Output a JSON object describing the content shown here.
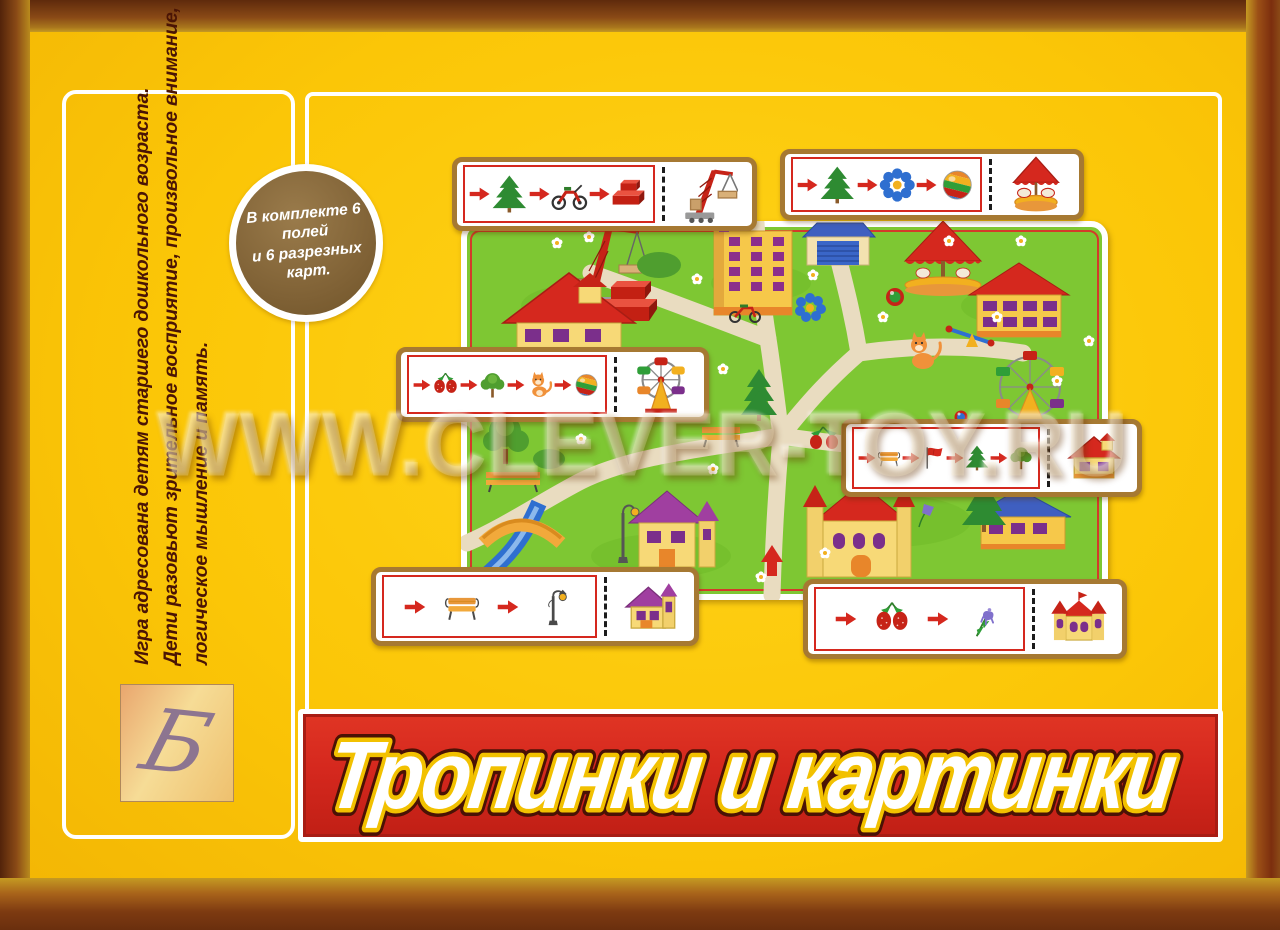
{
  "title": {
    "text": "Тропинки и картинки"
  },
  "badge": {
    "line1": "В комплекте 6 полей",
    "line2": "и 6 разрезных карт."
  },
  "left_panel": {
    "line1": "Игра адресована детям старшего дошкольного возраста.",
    "line2": "Дети разовьют зрительное восприятие, произвольное внимание,",
    "line3": "логическое мышление и память."
  },
  "watermark": {
    "text": "WWW.CLEVER-TOY.RU"
  },
  "logo": {
    "glyph": "Б"
  },
  "cards": [
    {
      "position": "top-left",
      "sequence": [
        "fir-tree",
        "motorcycle",
        "red-blocks"
      ],
      "target": "crane"
    },
    {
      "position": "top-right",
      "sequence": [
        "fir-tree",
        "blue-flower",
        "striped-ball"
      ],
      "target": "carousel"
    },
    {
      "position": "middle-left",
      "sequence": [
        "strawberry",
        "green-tree",
        "kitten",
        "striped-ball"
      ],
      "target": "ferris-wheel"
    },
    {
      "position": "middle-right",
      "sequence": [
        "bench",
        "red-flag",
        "fir-tree",
        "green-tree"
      ],
      "target": "red-roof-house"
    },
    {
      "position": "bottom-left",
      "sequence": [
        "bench",
        "street-lamp"
      ],
      "target": "purple-roof-house"
    },
    {
      "position": "bottom-right",
      "sequence": [
        "strawberry",
        "bluebell"
      ],
      "target": "castle-house"
    }
  ],
  "board": {
    "landmarks": [
      "crane",
      "red-blocks",
      "red-roof-house",
      "apartment-building",
      "garage",
      "carousel",
      "school-building",
      "ferris-wheel",
      "kitten",
      "seesaw",
      "motorcycle",
      "bridge",
      "river",
      "street-lamp",
      "purple-roof-house",
      "castle-house",
      "blue-roof-house",
      "benches",
      "fir-trees",
      "deciduous-trees",
      "daisies",
      "blue-flower",
      "bluebell",
      "strawberries",
      "striped-ball",
      "path-start-arrow"
    ]
  },
  "colors": {
    "background": "#FBC607",
    "frame_brown": "#8A4A16",
    "frame_dark": "#6E3010",
    "banner_red": "#D5281E",
    "board_green": "#7EC733",
    "path_beige": "#E9DCC0",
    "card_border": "#A67932",
    "arrow_red": "#D5281E",
    "badge_brown": "#7F6135",
    "left_text": "#4A1405"
  }
}
